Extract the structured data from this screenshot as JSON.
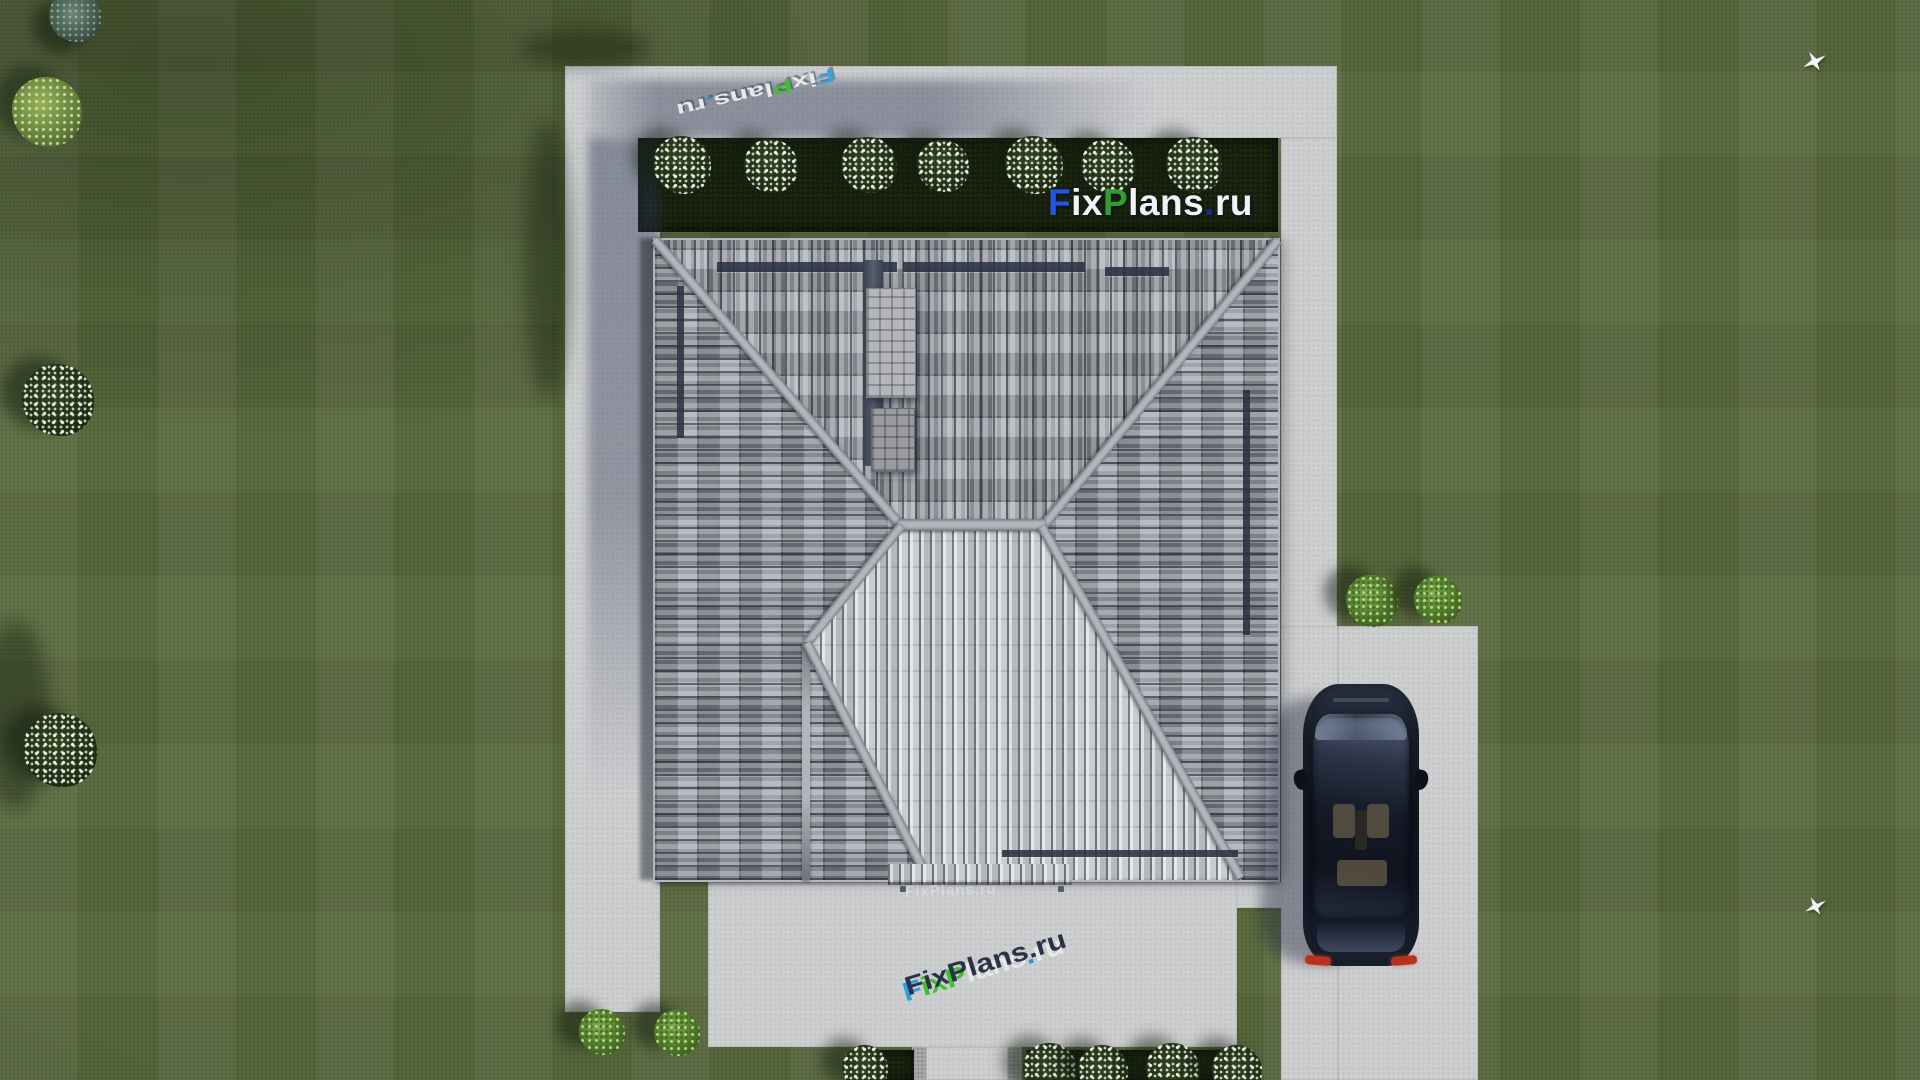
{
  "logo": {
    "full": "FixPlans.ru",
    "segments": [
      {
        "text": "F",
        "color": "#2456e0"
      },
      {
        "text": "ix",
        "color": "#f2f3f5"
      },
      {
        "text": "P",
        "color": "#2f9e33"
      },
      {
        "text": "lans",
        "color": "#f2f3f5"
      },
      {
        "text": ".",
        "color": "#1b2f8a"
      },
      {
        "text": "ru",
        "color": "#f2f3f5"
      }
    ],
    "ground_face_colors": {
      "blue": "#2ea6e4",
      "green": "#3fc22c",
      "white": "#ebebed",
      "dot_blue": "#2196e0",
      "extrusion_top": "#2b3147"
    }
  },
  "scene_colors": {
    "grass": "#5b6b3e",
    "pavement": "#cdced0",
    "hedge_bed": "#161f0d",
    "roof_tile_dark": "#5c6270",
    "roof_tile_light": "#c6c9cd",
    "ridge": "#b2b6bc",
    "car_body": "#10141e",
    "car_taillight": "#b5321f",
    "cast_shadow": "#2a3450"
  }
}
